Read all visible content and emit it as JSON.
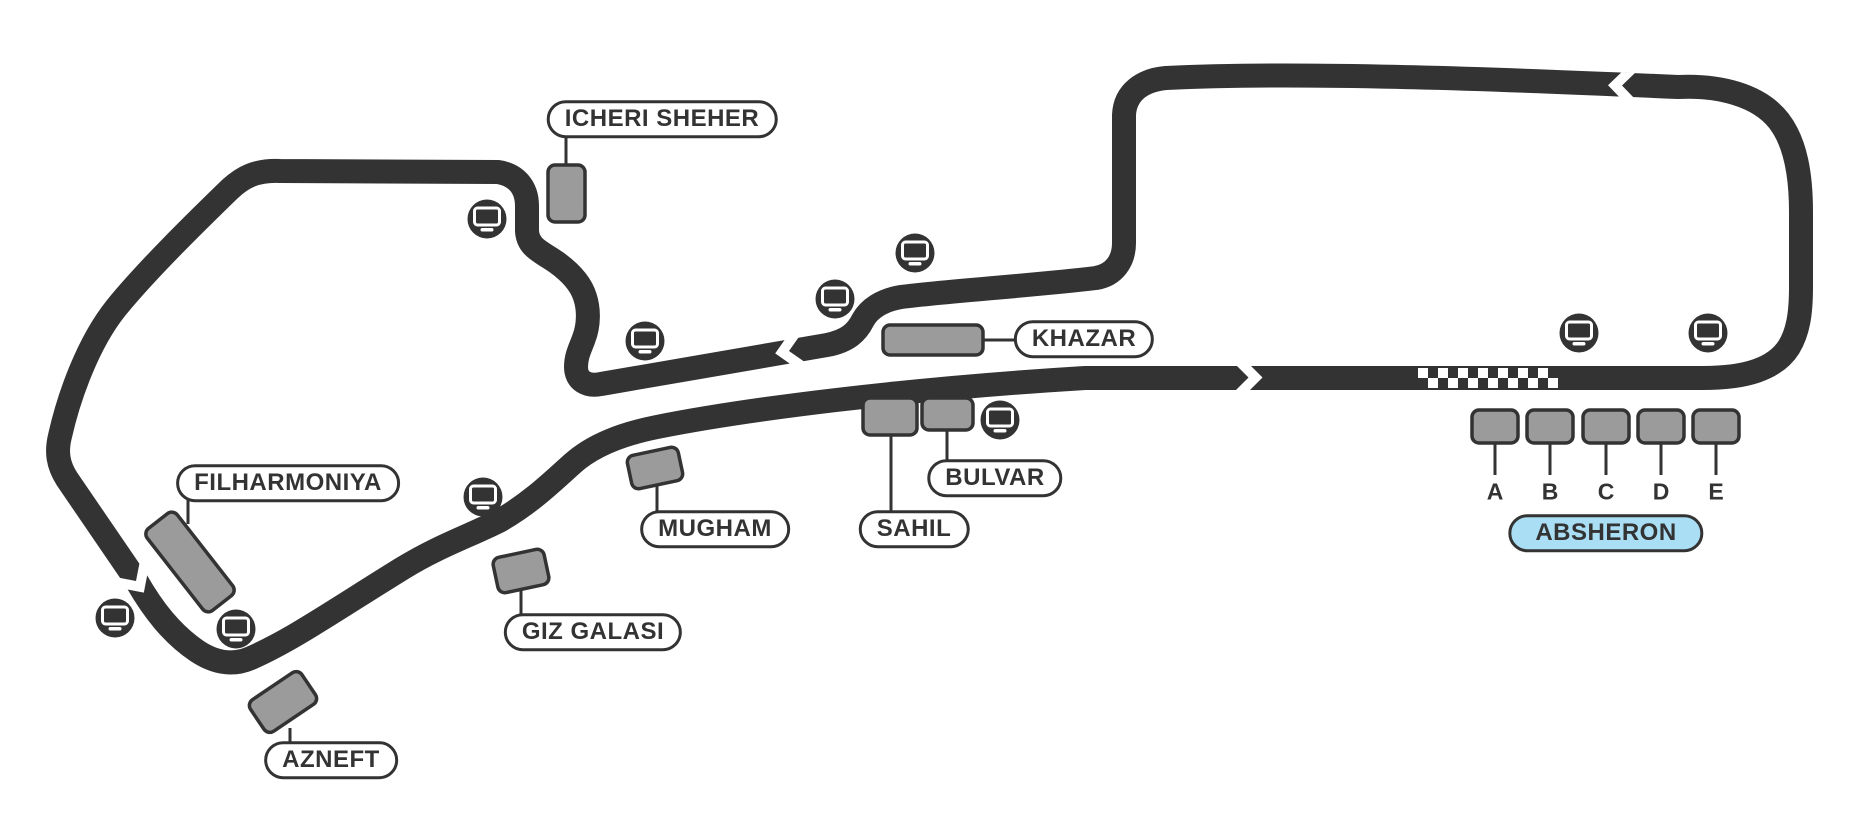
{
  "map": {
    "labels": {
      "icheri_sheher": "ICHERI SHEHER",
      "khazar": "KHAZAR",
      "filharmoniya": "FILHARMONIYA",
      "mugham": "MUGHAM",
      "giz_galasi": "GIZ GALASI",
      "azneft": "AZNEFT",
      "sahil": "SAHIL",
      "bulvar": "BULVAR",
      "absheron": "ABSHERON"
    },
    "absheron_sections": [
      "A",
      "B",
      "C",
      "D",
      "E"
    ],
    "selected_section": "C",
    "icons": {
      "screen": "tv-monitor-icon",
      "finish": "checkered-finish-line",
      "direction": "direction-chevron-arrow"
    },
    "colors": {
      "background": "#ffffff",
      "track": "#333333",
      "stand_fill": "#9b9b9b",
      "stand_border": "#333333",
      "selected_section_fill": "#41b8e8",
      "absheron_pill_fill": "#a9def5",
      "label_text": "#333333"
    }
  }
}
